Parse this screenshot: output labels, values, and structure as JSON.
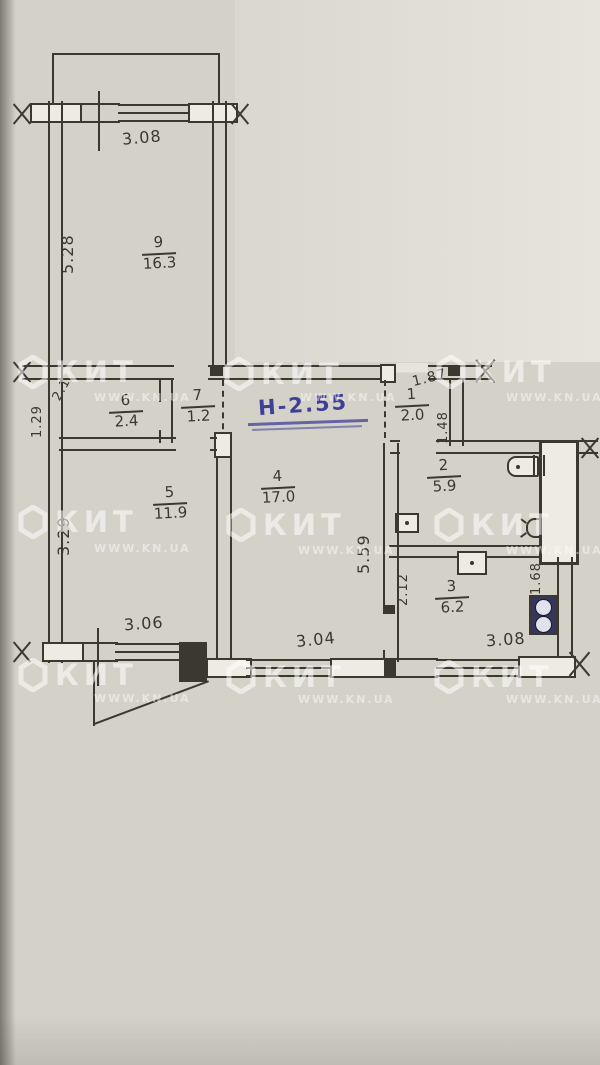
{
  "plan": {
    "note_height": "Н-2.55",
    "rooms": [
      {
        "id": "9",
        "num": "9",
        "area": "16.3"
      },
      {
        "id": "6",
        "num": "6",
        "area": "2.4"
      },
      {
        "id": "7",
        "num": "7",
        "area": "1.2"
      },
      {
        "id": "1",
        "num": "1",
        "area": "2.0"
      },
      {
        "id": "2",
        "num": "2",
        "area": "5.9"
      },
      {
        "id": "3",
        "num": "3",
        "area": "6.2"
      },
      {
        "id": "4",
        "num": "4",
        "area": "17.0"
      },
      {
        "id": "5",
        "num": "5",
        "area": "11.9"
      }
    ],
    "dimensions": {
      "top_width": "3.08",
      "room9_depth": "5.28",
      "corridor_niche": "1.29",
      "closet_depth": "2.1",
      "hall_top": "1.87",
      "hall_depth": "1.48",
      "room5_depth": "3.29",
      "room5_width": "3.06",
      "room4_width": "3.04",
      "room4_depth": "5.59",
      "kitchen_width": "3.08",
      "vent_offset": "1.68",
      "kitchen_depth": "2.12"
    },
    "fixtures": [
      "toilet-icon",
      "sink-icon",
      "kitchen-sink-icon",
      "stove-icon",
      "lamp-icon",
      "vent-shaft"
    ]
  },
  "watermark": {
    "brand": "КИТ",
    "url": "WWW.KN.UA"
  },
  "colors": {
    "ink": "#3b382f",
    "paper": "#d4d1c9",
    "paper_light": "#e7e4dd",
    "paper_bright": "#edebe4",
    "blue": "#3f3f96",
    "stove": "#35355f"
  }
}
